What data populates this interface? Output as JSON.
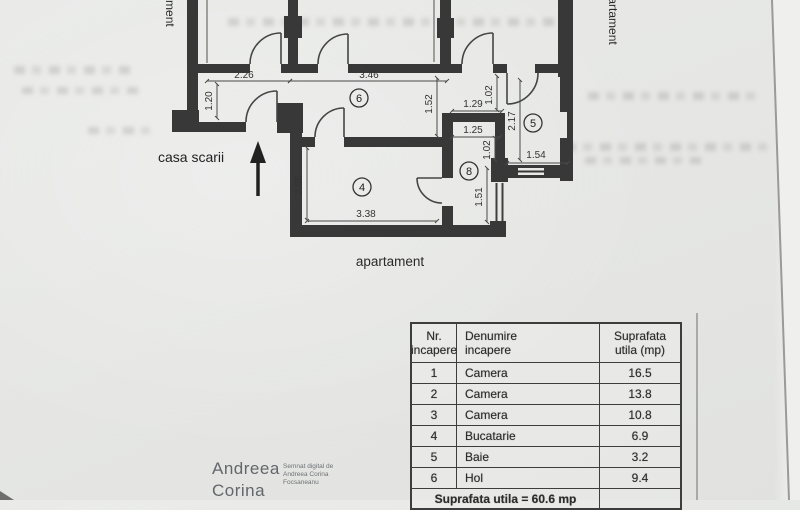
{
  "plan": {
    "labels": {
      "stairwell": "casa scarii",
      "apartment_bottom": "apartament",
      "apartment_right": "apartament",
      "apartment_left": "apartament"
    },
    "room_numbers": {
      "r4": "4",
      "r5": "5",
      "r6": "6",
      "r8": "8"
    },
    "dimensions": {
      "d_2_26": "2.26",
      "d_3_46": "3.46",
      "d_1_20": "1.20",
      "d_1_52": "1.52",
      "d_1_29": "1.29",
      "d_1_02_a": "1.02",
      "d_2_17": "2.17",
      "d_1_25": "1.25",
      "d_1_02_b": "1.02",
      "d_1_54": "1.54",
      "d_1_51": "1.51",
      "d_2_05": "2.05",
      "d_3_38": "3.38"
    }
  },
  "table": {
    "header": {
      "col1_line1": "Nr.",
      "col1_line2": "incapere",
      "col2_line1": "Denumire",
      "col2_line2": "incapere",
      "col3_line1": "Suprafata",
      "col3_line2": "utila (mp)"
    },
    "rows": [
      {
        "nr": "1",
        "name": "Camera",
        "area": "16.5"
      },
      {
        "nr": "2",
        "name": "Camera",
        "area": "13.8"
      },
      {
        "nr": "3",
        "name": "Camera",
        "area": "10.8"
      },
      {
        "nr": "4",
        "name": "Bucatarie",
        "area": "6.9"
      },
      {
        "nr": "5",
        "name": "Baie",
        "area": "3.2"
      },
      {
        "nr": "6",
        "name": "Hol",
        "area": "9.4"
      }
    ],
    "footer": "Suprafata utila = 60.6 mp"
  },
  "signature": {
    "name_line1": "Andreea",
    "name_line2": "Corina",
    "note_line1": "Semnat digital de",
    "note_line2": "Andreea Corina",
    "note_line3": "Focsaneanu"
  }
}
